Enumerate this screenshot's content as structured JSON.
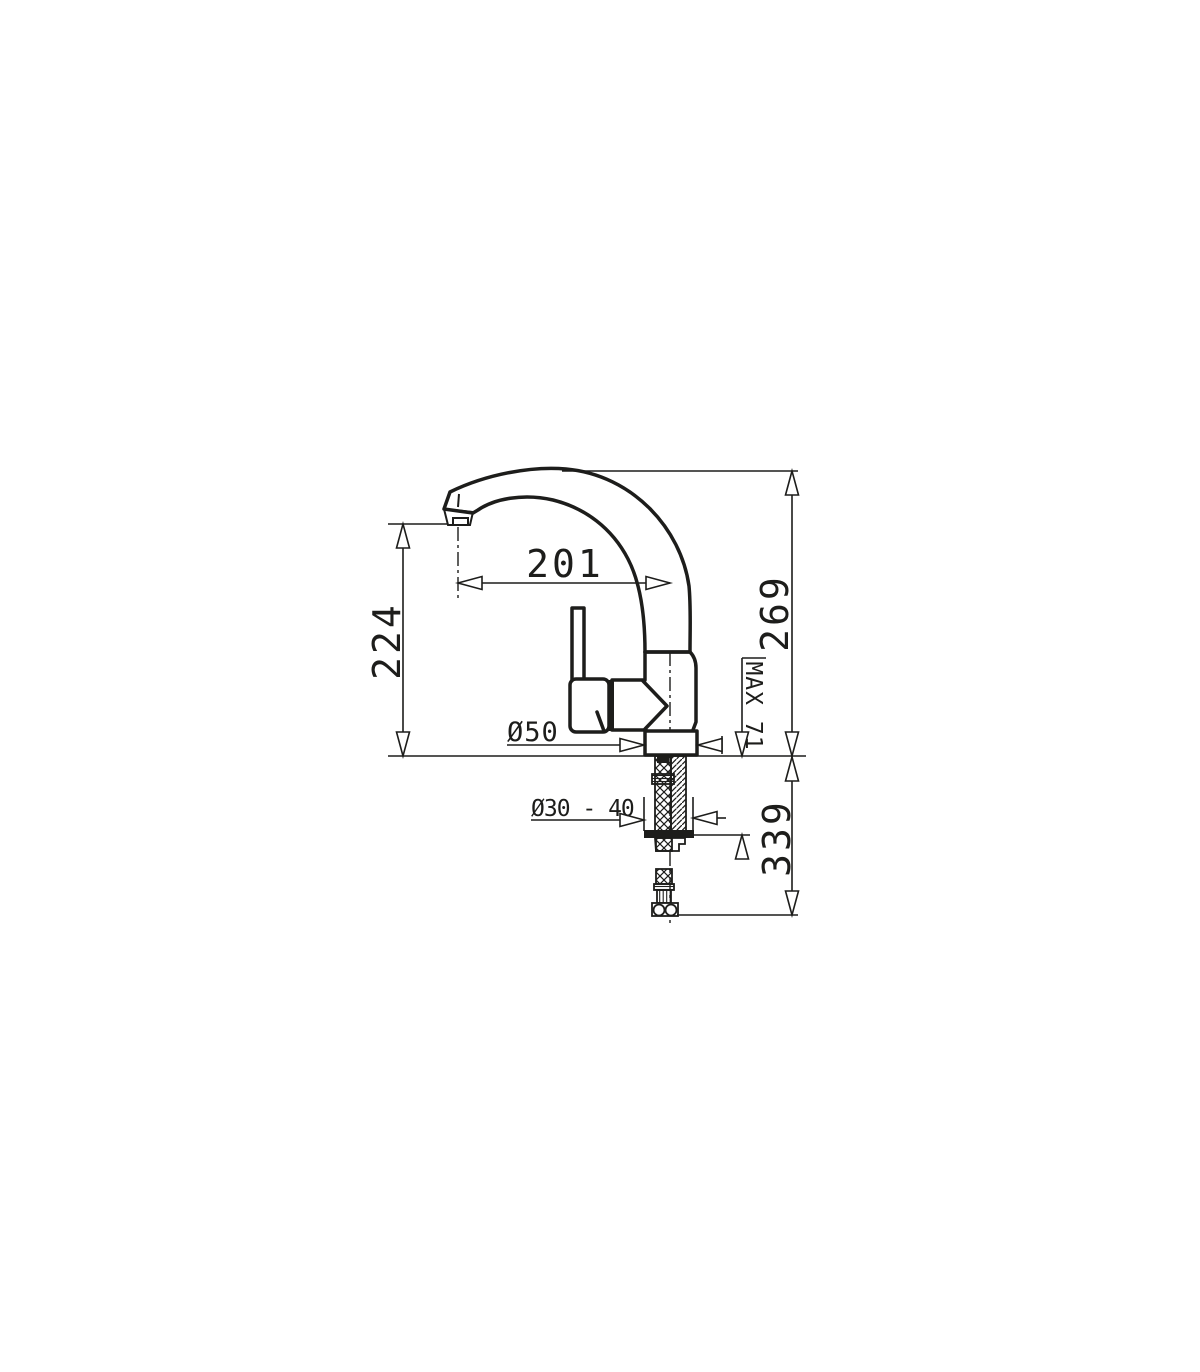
{
  "drawing": {
    "background": "#ffffff",
    "line_color": "#1d1d1b",
    "subject": "single-lever-mixer-tap-dimension-drawing",
    "labels": {
      "spout_reach": "201",
      "spout_height": "224",
      "overall_height": "269",
      "max_deck_thickness": "MAX 71",
      "base_diameter": "Ø50",
      "hole_diameter": "Ø30 - 40",
      "under_counter_depth": "339"
    }
  }
}
